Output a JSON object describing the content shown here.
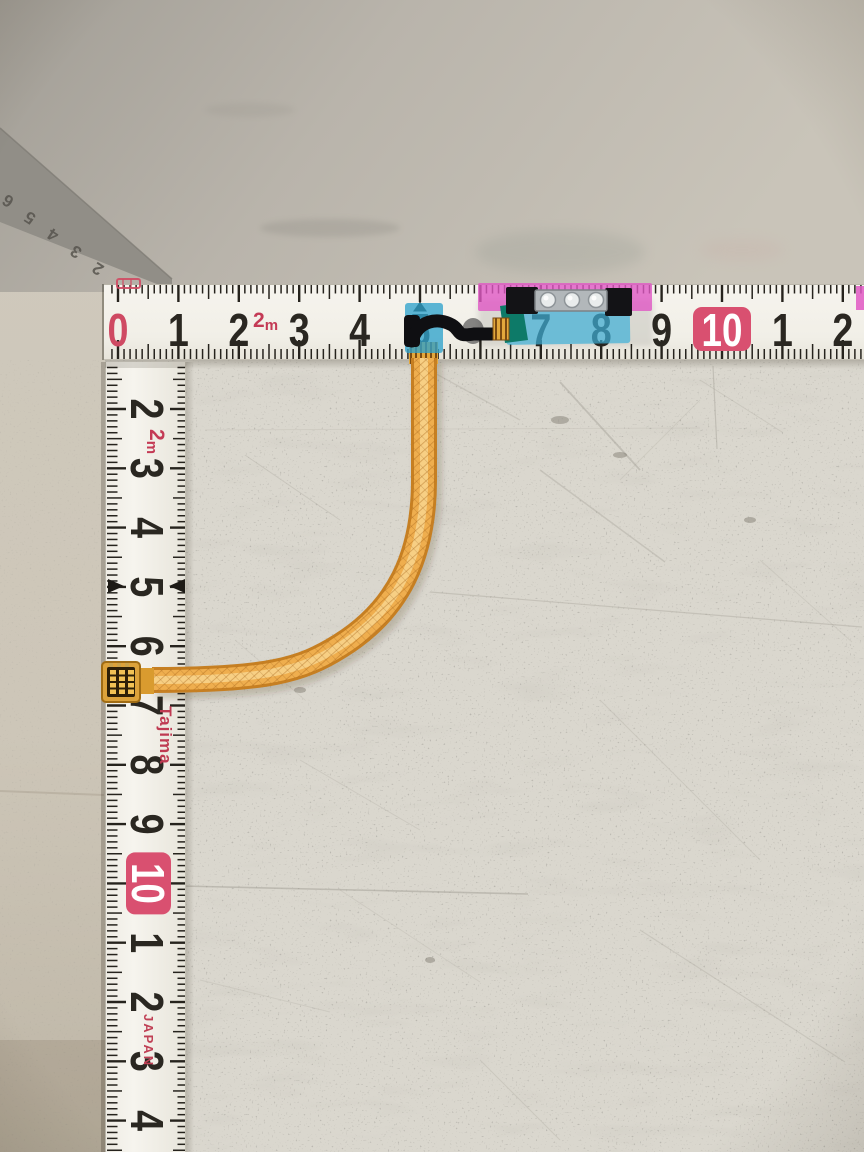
{
  "scene": {
    "kind": "photo of an orange flex ribbon cable measured with two Tajima measuring tapes on a speckled workbench"
  },
  "palette": {
    "surface": "#dad7ce",
    "left_strip": "#cdc6b9",
    "slab_dark": "#a7a39b",
    "slab_light": "#c9c4b9",
    "steel_band": "#918e87",
    "tape_white": "#f5f3ec",
    "tape_shade": "#e9e6dd",
    "tick": "#26231d",
    "digit": "#2a2721",
    "red_digit": "#cf4a63",
    "red_box": "#d95070",
    "unit_red": "#c43a55",
    "pink_tape": "#e058c4",
    "blue_tape": "#3fb0d8",
    "small_blue_tape": "#2fa3cc",
    "teal_tape": "#0d7a68",
    "black_part": "#131316",
    "metal_bracket": "#b2b7ba",
    "silver_dot": "#e9ecec",
    "gold_contact": "#e3a83c",
    "cable_edge": "#c67f22",
    "cable_mid": "#efae4e",
    "cable_core": "#f8d58e"
  },
  "edge_ruler": {
    "digits": [
      {
        "t": "2",
        "x": 101,
        "y": 264
      },
      {
        "t": "3",
        "x": 79,
        "y": 247
      },
      {
        "t": "4",
        "x": 56,
        "y": 230
      },
      {
        "t": "5",
        "x": 33,
        "y": 213
      },
      {
        "t": "6",
        "x": 11,
        "y": 196
      }
    ]
  },
  "h_tape": {
    "unit_label": "2m",
    "cm_labels": [
      "0",
      "1",
      "2",
      "3",
      "4",
      "5",
      null,
      "7",
      "8",
      "9",
      "10",
      "1",
      "2"
    ],
    "zero_index": 0,
    "red_box_index": 10
  },
  "v_tape": {
    "unit_label": "2m",
    "brand": "Tajima",
    "origin": "JAPAN",
    "cm_labels": [
      "2",
      "3",
      "4",
      "5",
      "6",
      "7",
      "8",
      "9",
      "10",
      "1",
      "2",
      "3",
      "4"
    ],
    "red_box_index": 8
  },
  "flex_cable": {
    "silver_contact_count": 3
  }
}
